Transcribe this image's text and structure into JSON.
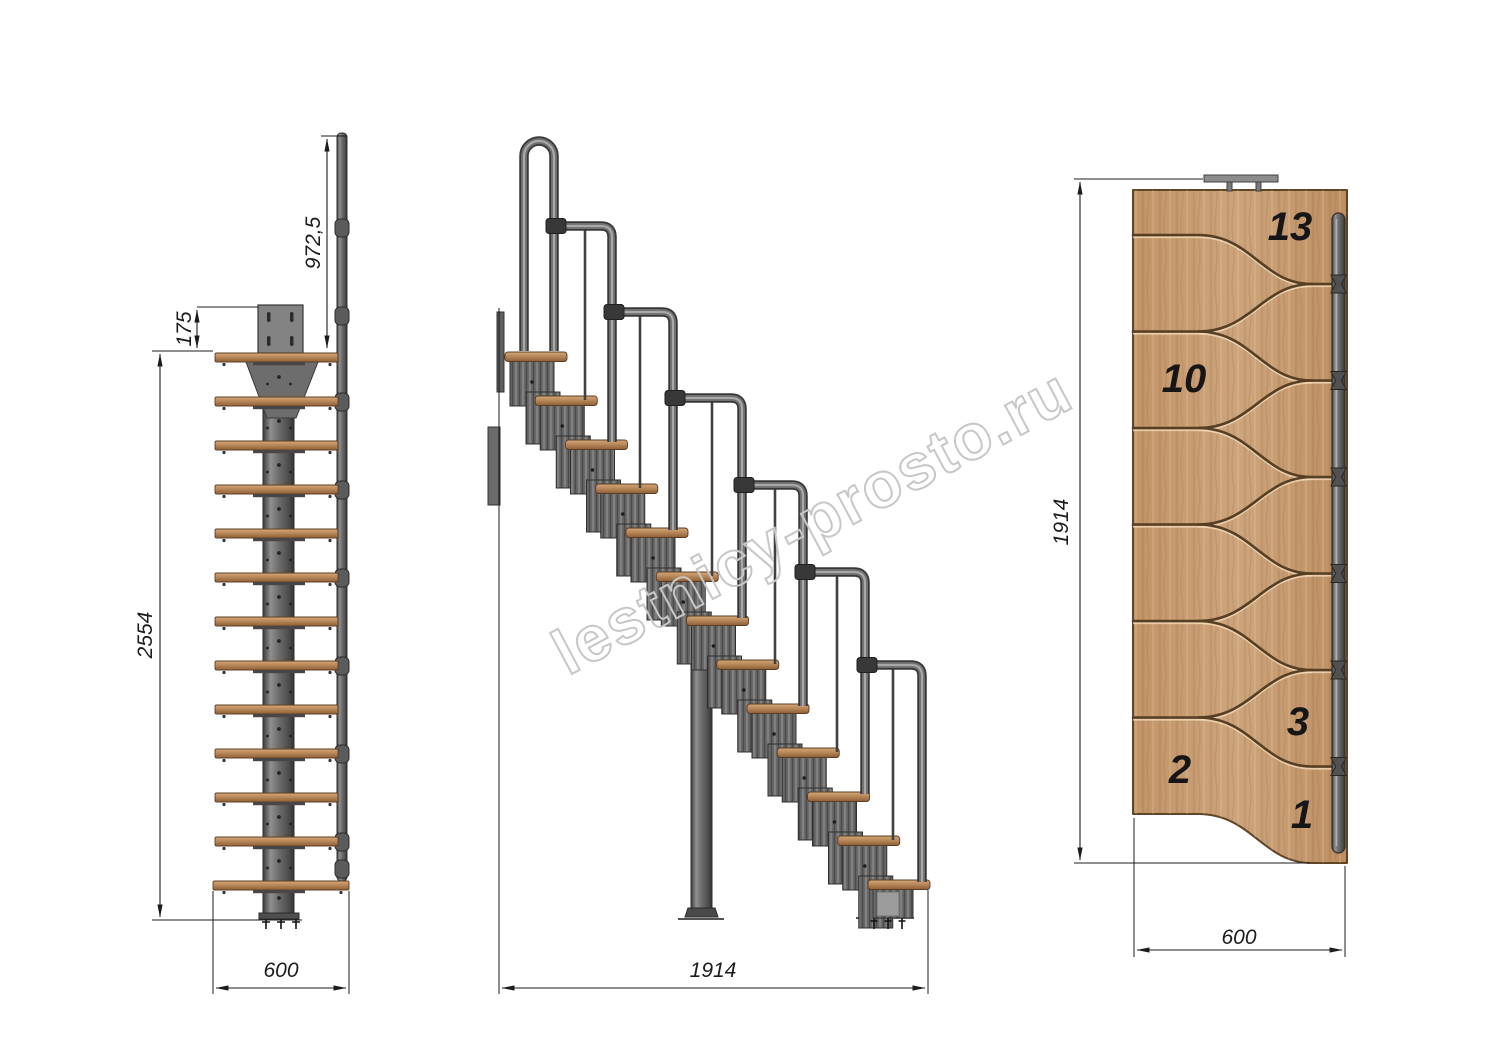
{
  "watermark": {
    "text": "lestnicy-prosto.ru"
  },
  "views": {
    "front": {
      "name": "front elevation",
      "dimensions": {
        "handrail_height": "972,5",
        "top_plate_offset": "175",
        "total_height": "2554",
        "width": "600"
      }
    },
    "side": {
      "name": "side elevation",
      "dimensions": {
        "total_run": "1914"
      }
    },
    "plan": {
      "name": "top plan view",
      "step_count": 13,
      "dimensions": {
        "total_run": "1914",
        "width": "600"
      },
      "tread_numbers": {
        "t13": "13",
        "t10": "10",
        "t3": "3",
        "t2": "2",
        "t1": "1"
      }
    }
  },
  "colors": {
    "wood": "#b9885a",
    "wood_plan": "#c79d74",
    "metal": "#6d6d6d",
    "dimension": "#1c1c1c",
    "watermark": "#c7c7c7",
    "background": "#ffffff"
  }
}
